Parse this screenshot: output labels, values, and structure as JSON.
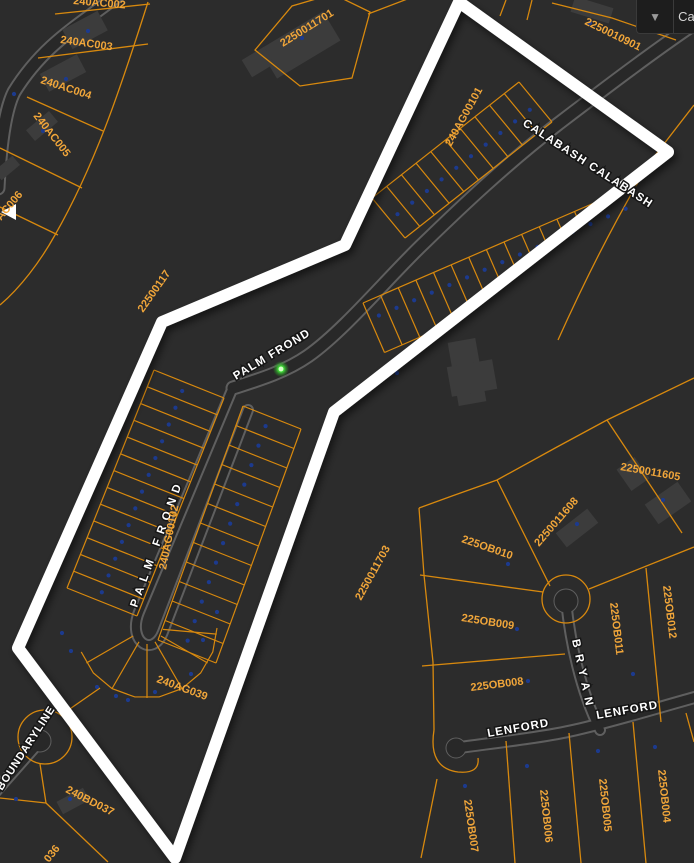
{
  "app": {
    "toolbar": {
      "chevron_icon": "▼",
      "label_fragment": "Ca"
    }
  },
  "map": {
    "colors": {
      "background": "#2c2c2c",
      "parcel_line": "#d8890e",
      "parcel_label": "#f1a63a",
      "road_fill": "#282828",
      "road_casing": "#5f5f5f",
      "boundary": "#ffffff",
      "point_marker": "#1c3a8e",
      "selected_point": "#46e83c"
    },
    "street_labels": [
      {
        "text": "CALABASH CALABASH",
        "x": 522,
        "y": 125,
        "rot": 33,
        "ls": 1.2,
        "size": 11.5
      },
      {
        "text": "PALM FROND",
        "x": 236,
        "y": 380,
        "rot": -31,
        "ls": 1.2,
        "size": 11.5
      },
      {
        "text": "PALM FROND",
        "x": 137,
        "y": 608,
        "rot": -70,
        "ls": 6,
        "size": 11.5
      },
      {
        "text": "BOUNDARYLINE",
        "x": 2,
        "y": 791,
        "rot": -57,
        "ls": 0.8,
        "size": 11
      },
      {
        "text": "BRYAN",
        "x": 572,
        "y": 640,
        "rot": 78,
        "ls": 7,
        "size": 11.5
      },
      {
        "text": "LENFORD",
        "x": 488,
        "y": 737,
        "rot": -10,
        "ls": 1,
        "size": 11.5
      },
      {
        "text": "LENFORD",
        "x": 597,
        "y": 719,
        "rot": -10,
        "ls": 1,
        "size": 11.5
      }
    ],
    "parcel_labels": [
      {
        "text": "240AC002",
        "x": 73,
        "y": 4,
        "rot": 5
      },
      {
        "text": "240AC003",
        "x": 60,
        "y": 43,
        "rot": 8
      },
      {
        "text": "240AC004",
        "x": 40,
        "y": 83,
        "rot": 18
      },
      {
        "text": "240AC005",
        "x": 33,
        "y": 116,
        "rot": 52
      },
      {
        "text": "AC006",
        "x": 1,
        "y": 221,
        "rot": -50
      },
      {
        "text": "2250011701",
        "x": 283,
        "y": 47,
        "rot": -32
      },
      {
        "text": "2250010901",
        "x": 584,
        "y": 24,
        "rot": 26
      },
      {
        "text": "240AG00101",
        "x": 451,
        "y": 147,
        "rot": -61
      },
      {
        "text": "22500117",
        "x": 143,
        "y": 313,
        "rot": -55
      },
      {
        "text": "240AG00102",
        "x": 166,
        "y": 570,
        "rot": -79
      },
      {
        "text": "240AG039",
        "x": 156,
        "y": 682,
        "rot": 20
      },
      {
        "text": "2250011703",
        "x": 361,
        "y": 601,
        "rot": -61
      },
      {
        "text": "2250011605",
        "x": 620,
        "y": 470,
        "rot": 10
      },
      {
        "text": "2250011608",
        "x": 539,
        "y": 547,
        "rot": -49
      },
      {
        "text": "225OB010",
        "x": 461,
        "y": 542,
        "rot": 19
      },
      {
        "text": "225OB009",
        "x": 461,
        "y": 621,
        "rot": 9
      },
      {
        "text": "225OB008",
        "x": 471,
        "y": 691,
        "rot": -7
      },
      {
        "text": "225OB007",
        "x": 464,
        "y": 800,
        "rot": 82
      },
      {
        "text": "225OB006",
        "x": 540,
        "y": 790,
        "rot": 84
      },
      {
        "text": "225OB005",
        "x": 599,
        "y": 779,
        "rot": 84
      },
      {
        "text": "225OB004",
        "x": 658,
        "y": 770,
        "rot": 84
      },
      {
        "text": "225OB011",
        "x": 610,
        "y": 603,
        "rot": 83
      },
      {
        "text": "225OB012",
        "x": 663,
        "y": 586,
        "rot": 83
      },
      {
        "text": "240BD037",
        "x": 65,
        "y": 792,
        "rot": 27
      },
      {
        "text": "036",
        "x": 49,
        "y": 863,
        "rot": -52
      }
    ],
    "point_markers": [
      [
        88,
        31
      ],
      [
        66,
        79
      ],
      [
        43,
        131
      ],
      [
        14,
        94
      ],
      [
        302,
        38
      ],
      [
        590,
        23
      ],
      [
        397,
        373
      ],
      [
        663,
        500
      ],
      [
        577,
        524
      ],
      [
        508,
        564
      ],
      [
        517,
        629
      ],
      [
        528,
        681
      ],
      [
        633,
        674
      ],
      [
        465,
        786
      ],
      [
        527,
        766
      ],
      [
        598,
        751
      ],
      [
        655,
        747
      ],
      [
        70,
        799
      ],
      [
        16,
        799
      ],
      [
        62,
        633
      ],
      [
        71,
        651
      ],
      [
        97,
        687
      ],
      [
        116,
        696
      ],
      [
        128,
        700
      ],
      [
        155,
        692
      ],
      [
        191,
        674
      ],
      [
        203,
        640
      ],
      [
        217,
        612
      ]
    ],
    "selected_point": {
      "x": 281,
      "y": 369
    }
  }
}
